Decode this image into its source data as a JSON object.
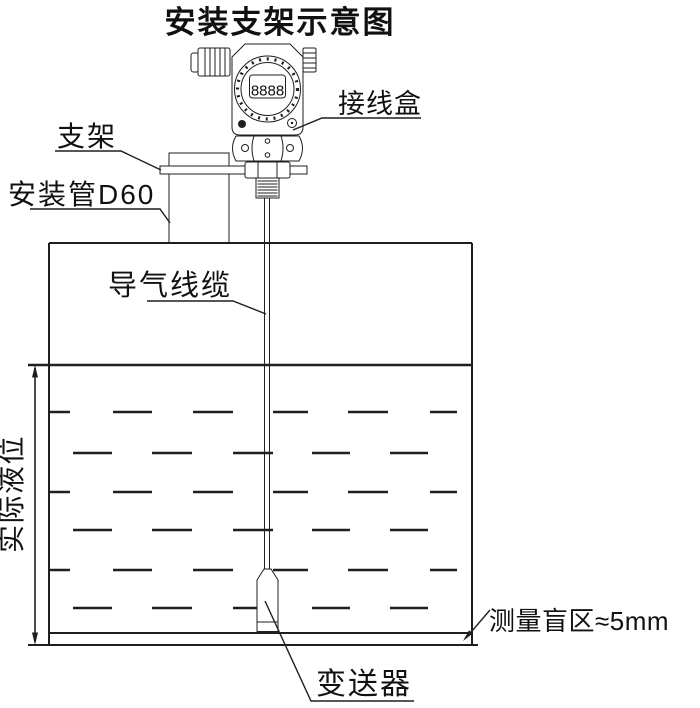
{
  "title": "安装支架示意图",
  "colors": {
    "line": "#1f1f1f",
    "text": "#111111",
    "background": "#ffffff"
  },
  "device": {
    "lcd_reading": "8888"
  },
  "callouts": {
    "junction_box": "接线盒",
    "bracket": "支架",
    "mounting_pipe": "安装管D60",
    "air_cable": "导气线缆",
    "actual_level": "实际液位",
    "transmitter": "变送器",
    "blind_zone": "测量盲区≈5mm"
  }
}
